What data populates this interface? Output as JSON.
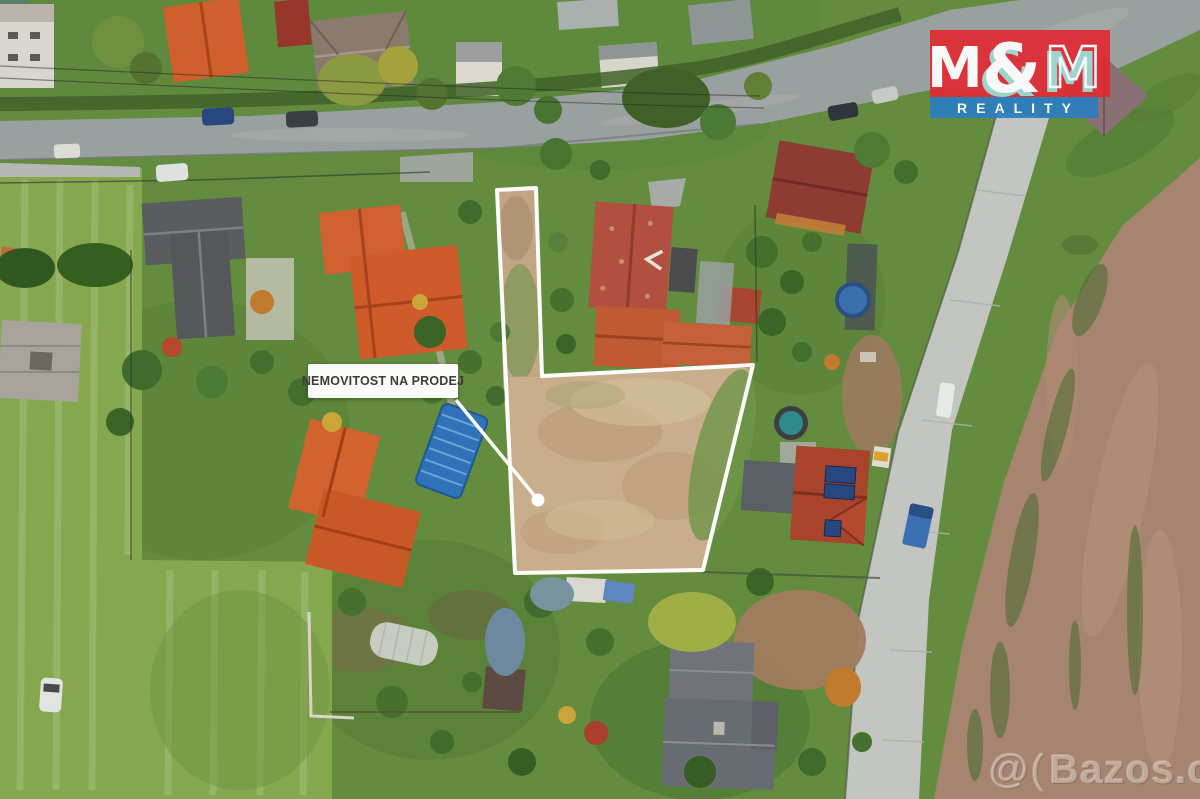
{
  "sale_label": {
    "text": "NEMOVITOST NA PRODEJ"
  },
  "logo": {
    "m_left": "M",
    "ampersand": "&",
    "m_right": "M",
    "subtitle": "REALITY",
    "red": "#e02b33",
    "blue": "#2d7dc2",
    "teal": "#9ed8d2"
  },
  "watermark": {
    "icon": "@(",
    "text": "Bazos.cz"
  },
  "plot": {
    "outline_color": "#ffffff"
  },
  "palette": {
    "grass": "#648c3f",
    "meadow": "#85a84e",
    "plot_dead_grass": "#c8ae8c",
    "asphalt_road": "#9aa09f",
    "concrete_road": "#c2c5c0",
    "field_brown": "#a6846f",
    "roof_orange": "#cf5f2d",
    "roof_weathered_red": "#b25040",
    "roof_dark_gray": "#5b5f63",
    "pool_blue": "#2f72b8"
  }
}
